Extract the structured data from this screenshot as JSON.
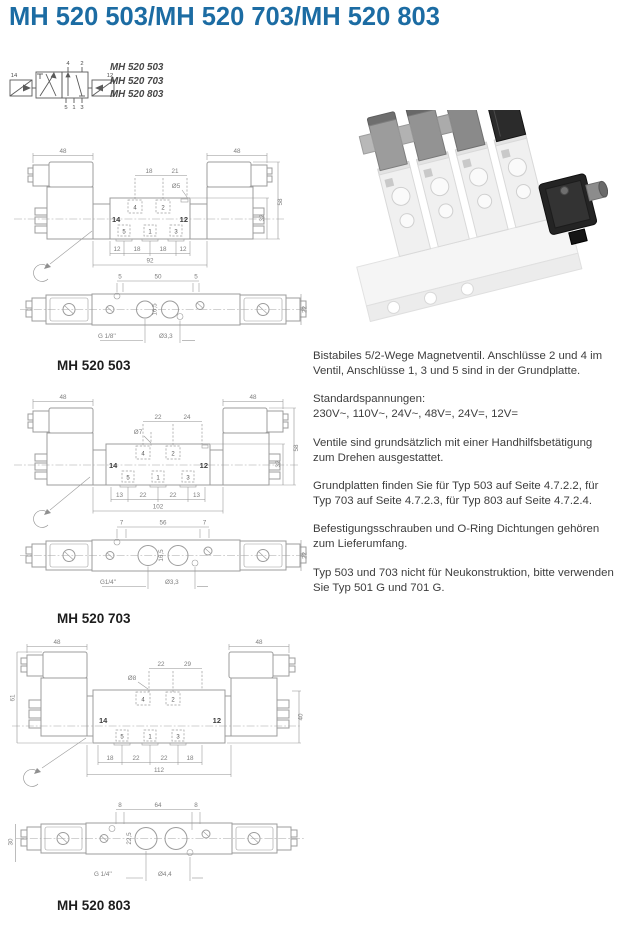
{
  "page": {
    "title": "MH 520 503/MH 520 703/MH 520 803"
  },
  "colors": {
    "accent_blue": "#1c6ca3",
    "text_gray": "#3d3d3d",
    "line_gray": "#9c9c9c"
  },
  "symbol": {
    "variants": [
      "MH 520 503",
      "MH 520 703",
      "MH 520 803"
    ],
    "ports": {
      "p14": "14",
      "p12": "12",
      "p4": "4",
      "p2": "2",
      "p5": "5",
      "p1": "1",
      "p3": "3"
    }
  },
  "photo": {
    "name": "valve-manifold-product-photo"
  },
  "info": {
    "paragraphs": [
      "Bistabiles 5/2-Wege Magnetventil. Anschlüsse 2 und 4 im Ventil, Anschlüsse 1, 3 und 5 sind in der Grundplatte.",
      "Standardspannungen:\n230V~, 110V~, 24V~, 48V=, 24V=, 12V=",
      "Ventile sind grundsätzlich mit einer Handhilfsbetätigung zum Drehen ausgestattet.",
      "Grundplatten finden Sie für Typ 503 auf Seite 4.7.2.2, für Typ 703 auf Seite 4.7.2.3, für Typ 803 auf Seite 4.7.2.4.",
      "Befestigungsschrauben und O-Ring Dichtungen gehören zum Lieferumfang.",
      "Typ 503 und 703 nicht für Neukonstruktion, bitte verwenden Sie Typ 501 G und 701 G."
    ]
  },
  "drawings": [
    {
      "label": "MH 520 503",
      "ports": {
        "p4": "4",
        "p2": "2",
        "p14": "14",
        "p12": "12",
        "p5": "5",
        "p1": "1",
        "p3": "3"
      },
      "dims": {
        "coil_left": "48",
        "coil_right": "48",
        "pitch_a": "18",
        "pitch_b": "21",
        "hole": "Ø5",
        "total_height": "58",
        "body_height": "32",
        "m1": "12",
        "m2": "18",
        "m3": "18",
        "m4": "12",
        "length": "92",
        "bv_a": "5",
        "bv_b": "50",
        "bv_c": "5",
        "bv_depth": "16,5",
        "bv_height": "22",
        "thread": "G 1/8''",
        "pilot_hole": "Ø3,3"
      }
    },
    {
      "label": "MH 520 703",
      "ports": {
        "p4": "4",
        "p2": "2",
        "p14": "14",
        "p12": "12",
        "p5": "5",
        "p1": "1",
        "p3": "3"
      },
      "dims": {
        "coil_left": "48",
        "coil_right": "48",
        "pitch_a": "22",
        "pitch_b": "24",
        "hole": "Ø7",
        "total_height": "58",
        "body_height": "32",
        "m1": "13",
        "m2": "22",
        "m3": "22",
        "m4": "13",
        "length": "102",
        "bv_a": "7",
        "bv_b": "56",
        "bv_c": "7",
        "bv_depth": "16,5",
        "bv_height": "22",
        "thread": "G1/4''",
        "pilot_hole": "Ø3,3"
      }
    },
    {
      "label": "MH 520 803",
      "ports": {
        "p4": "4",
        "p2": "2",
        "p14": "14",
        "p12": "12",
        "p5": "5",
        "p1": "1",
        "p3": "3"
      },
      "dims": {
        "coil_left": "48",
        "coil_right": "48",
        "pitch_a": "22",
        "pitch_b": "29",
        "hole": "Ø8",
        "total_height": "61",
        "body_height": "40",
        "m1": "18",
        "m2": "22",
        "m3": "22",
        "m4": "18",
        "length": "112",
        "bv_a": "8",
        "bv_b": "64",
        "bv_c": "8",
        "bv_depth": "22,5",
        "bv_height": "30",
        "thread": "G 1/4''",
        "pilot_hole": "Ø4,4"
      }
    }
  ]
}
